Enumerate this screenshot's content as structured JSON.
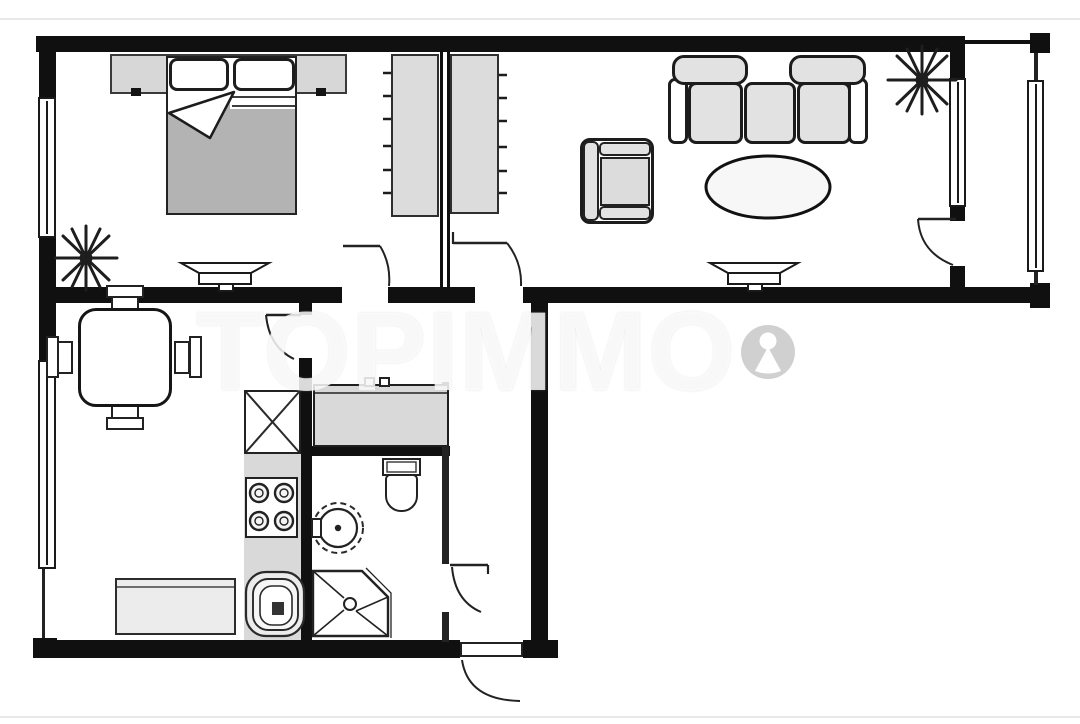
{
  "watermark": {
    "text": "TOPIMMO",
    "logo": "person-in-circle"
  },
  "palette": {
    "background": "#ffffff",
    "wall": "#101010",
    "furniture_outline": "#222222",
    "furniture_fill": "#dcdcdc",
    "blanket_fill": "#b3b3b3",
    "watermark_color": "rgba(253,253,253,0.82)"
  },
  "floor_plan": {
    "type": "apartment",
    "rooms": [
      {
        "name": "bedroom",
        "furniture": [
          "double-bed",
          "pillows",
          "wardrobe-strip",
          "plant",
          "radiator",
          "window"
        ]
      },
      {
        "name": "hall-closets",
        "furniture": [
          "wardrobe-left",
          "wardrobe-right"
        ]
      },
      {
        "name": "living-room",
        "furniture": [
          "three-seat-sofa",
          "armchair",
          "oval-rug",
          "radiator",
          "plant",
          "window"
        ]
      },
      {
        "name": "balcony",
        "furniture": [
          "glazing-window"
        ]
      },
      {
        "name": "kitchen-dining",
        "furniture": [
          "dining-table",
          "chairs-4",
          "sideboard-bench",
          "tall-cabinet",
          "stove-4-burners",
          "corner-sink",
          "window"
        ]
      },
      {
        "name": "entry-hall",
        "furniture": [
          "vanity-console"
        ]
      },
      {
        "name": "bathroom",
        "furniture": [
          "toilet",
          "round-washbasin",
          "shower-tray"
        ]
      },
      {
        "name": "hallway",
        "furniture": []
      }
    ],
    "doors": [
      "bedroom-door",
      "living-room-door",
      "kitchen-door",
      "bathroom-door",
      "balcony-door",
      "entrance-door"
    ],
    "windows_count": 4
  }
}
